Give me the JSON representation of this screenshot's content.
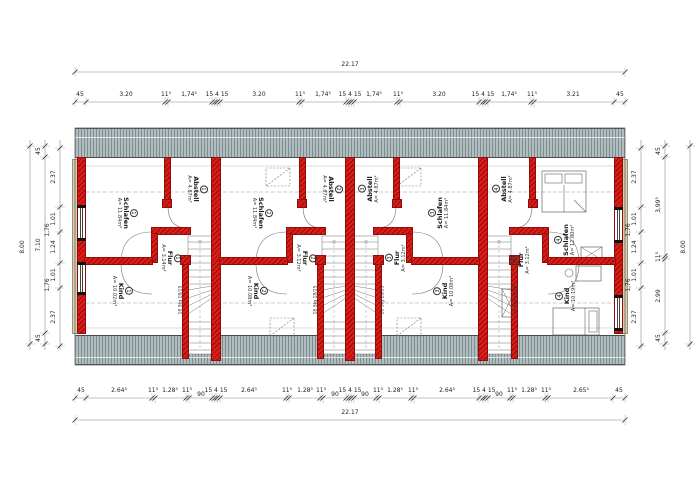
{
  "dimensions": {
    "top": {
      "total": "22.17",
      "segments": [
        {
          "t": "45",
          "x": 80
        },
        {
          "t": "3.20",
          "x": 126
        },
        {
          "t": "11⁵",
          "x": 166
        },
        {
          "t": "1,74⁵",
          "x": 189
        },
        {
          "t": "15 4 15",
          "x": 217
        },
        {
          "t": "3.20",
          "x": 259
        },
        {
          "t": "11⁵",
          "x": 300
        },
        {
          "t": "1,74⁵",
          "x": 323
        },
        {
          "t": "15 4 15",
          "x": 350
        },
        {
          "t": "1,74⁵",
          "x": 374
        },
        {
          "t": "11⁵",
          "x": 398
        },
        {
          "t": "3.20",
          "x": 439
        },
        {
          "t": "15 4 15",
          "x": 483
        },
        {
          "t": "1,74⁵",
          "x": 509
        },
        {
          "t": "11⁵",
          "x": 532
        },
        {
          "t": "3.21",
          "x": 573
        },
        {
          "t": "45",
          "x": 620
        }
      ],
      "ticks": [
        75,
        86,
        165,
        168,
        212,
        215,
        217,
        220,
        299,
        302,
        346,
        349,
        351,
        354,
        397,
        400,
        479,
        483,
        485,
        488,
        531,
        534,
        614,
        625
      ]
    },
    "bottom": {
      "total": "22.17",
      "segments": [
        {
          "t": "45",
          "x": 81
        },
        {
          "t": "2.64⁵",
          "x": 119
        },
        {
          "t": "11⁵",
          "x": 153
        },
        {
          "t": "1.28⁵",
          "x": 170
        },
        {
          "t": "11⁵",
          "x": 187
        },
        {
          "t": "90",
          "x": 201,
          "dy": 4
        },
        {
          "t": "15 4 15",
          "x": 216
        },
        {
          "t": "2.64⁵",
          "x": 249
        },
        {
          "t": "11⁵",
          "x": 287
        },
        {
          "t": "1.28⁵",
          "x": 305
        },
        {
          "t": "11⁵",
          "x": 321
        },
        {
          "t": "90",
          "x": 335,
          "dy": 4
        },
        {
          "t": "15 4 15",
          "x": 350
        },
        {
          "t": "90",
          "x": 365,
          "dy": 4
        },
        {
          "t": "11⁵",
          "x": 378
        },
        {
          "t": "1.28⁵",
          "x": 395
        },
        {
          "t": "11⁵",
          "x": 413
        },
        {
          "t": "2.64⁵",
          "x": 447
        },
        {
          "t": "15 4 15",
          "x": 484
        },
        {
          "t": "90",
          "x": 499,
          "dy": 4
        },
        {
          "t": "11⁵",
          "x": 512
        },
        {
          "t": "1.28⁵",
          "x": 529
        },
        {
          "t": "11⁵",
          "x": 546
        },
        {
          "t": "2.65⁵",
          "x": 581
        },
        {
          "t": "45",
          "x": 619
        }
      ],
      "ticks": [
        75,
        86,
        152,
        155,
        186,
        189,
        212,
        215,
        217,
        220,
        286,
        289,
        320,
        323,
        346,
        349,
        351,
        354,
        376,
        379,
        411,
        414,
        479,
        483,
        485,
        488,
        510,
        513,
        545,
        548,
        613,
        625
      ]
    },
    "left": {
      "total": "8.00",
      "outer": [
        {
          "t": "45",
          "y": 151
        },
        {
          "t": "7.10",
          "y": 245
        },
        {
          "t": "45",
          "y": 338
        }
      ],
      "outer_ticks": [
        146,
        157,
        333,
        344
      ],
      "inner": [
        {
          "t": "2.37",
          "y": 177
        },
        {
          "t": "1.01",
          "y": 219
        },
        {
          "t": "1.24",
          "y": 247
        },
        {
          "t": "1.01",
          "y": 275
        },
        {
          "t": "2.37",
          "y": 317
        }
      ],
      "inner_ticks": [
        148,
        207,
        232,
        263,
        288,
        346
      ],
      "window": [
        {
          "t": "1,76",
          "y": 230
        },
        {
          "t": "1,76",
          "y": 285
        }
      ]
    },
    "right": {
      "total": "8.00",
      "outer": [
        {
          "t": "45",
          "y": 151
        },
        {
          "t": "3,99⁵",
          "y": 205
        },
        {
          "t": "11⁵",
          "y": 257
        },
        {
          "t": "2.99",
          "y": 296
        },
        {
          "t": "45",
          "y": 338
        }
      ],
      "outer_ticks": [
        146,
        157,
        256,
        259,
        333,
        344
      ],
      "inner": [
        {
          "t": "2.37",
          "y": 177
        },
        {
          "t": "1.01",
          "y": 219
        },
        {
          "t": "1.24",
          "y": 247
        },
        {
          "t": "1.01",
          "y": 275
        },
        {
          "t": "2.37",
          "y": 317
        }
      ],
      "inner_ticks": [
        148,
        207,
        232,
        263,
        288,
        346
      ],
      "window": [
        {
          "t": "1,76",
          "y": 230
        },
        {
          "t": "1,76",
          "y": 285
        }
      ]
    }
  },
  "units": [
    {
      "number": "1",
      "rot": 90,
      "rooms": [
        {
          "name": "Schlafen",
          "area": "A= 11.84m²",
          "x": 127,
          "y": 213
        },
        {
          "name": "Abstell",
          "area": "A= 4.87m²",
          "x": 197,
          "y": 189
        },
        {
          "name": "Flur",
          "area": "A= 3.14m²",
          "x": 171,
          "y": 258
        },
        {
          "name": "Kind",
          "area": "A= 10.02m²",
          "x": 122,
          "y": 291
        }
      ],
      "stair_note": "18 Stg 18/25",
      "note_x": 181,
      "note_y": 300
    },
    {
      "number": "2",
      "rot": 90,
      "rooms": [
        {
          "name": "Schlafen",
          "area": "A= 11.84m²",
          "x": 262,
          "y": 213
        },
        {
          "name": "Abstell",
          "area": "A= 4.87m²",
          "x": 332,
          "y": 189
        },
        {
          "name": "Flur",
          "area": "A= 3.12m²",
          "x": 306,
          "y": 258
        },
        {
          "name": "Kind",
          "area": "A= 10.08m²",
          "x": 257,
          "y": 291
        }
      ],
      "stair_note": "18 Stg 18/25",
      "note_x": 316,
      "note_y": 300
    },
    {
      "number": "3",
      "rot": -90,
      "rooms": [
        {
          "name": "Schlafen",
          "area": "A= 11.84m²",
          "x": 439,
          "y": 213
        },
        {
          "name": "Abstell",
          "area": "A= 4.87m²",
          "x": 369,
          "y": 189
        },
        {
          "name": "Flur",
          "area": "A= 3.12m²",
          "x": 396,
          "y": 258
        },
        {
          "name": "Kind",
          "area": "A= 10.08m²",
          "x": 444,
          "y": 291
        }
      ],
      "stair_note": "18 Stg 18/25",
      "note_x": 383,
      "note_y": 300
    },
    {
      "number": "4",
      "rot": -90,
      "rooms": [
        {
          "name": "Schlafen",
          "area": "A= 12.80m²",
          "x": 565,
          "y": 240
        },
        {
          "name": "Abstell",
          "area": "A= 4.87m²",
          "x": 503,
          "y": 189
        },
        {
          "name": "Flur",
          "area": "A= 3.12m²",
          "x": 520,
          "y": 260
        },
        {
          "name": "Kind",
          "area": "A= 10.19m²",
          "x": 566,
          "y": 296
        }
      ],
      "stair_note": "18 Stg 18/25",
      "note_x": 516,
      "note_y": 300
    }
  ],
  "colors": {
    "wall": "#de1b16",
    "wall_dark": "#8f0d0a",
    "roof_light": "#b1bdbe",
    "roof_dark": "#7b8d8f",
    "facade": "#d9cdab",
    "line": "#555555",
    "dim": "#222222",
    "dash": "#9a9a9a"
  }
}
